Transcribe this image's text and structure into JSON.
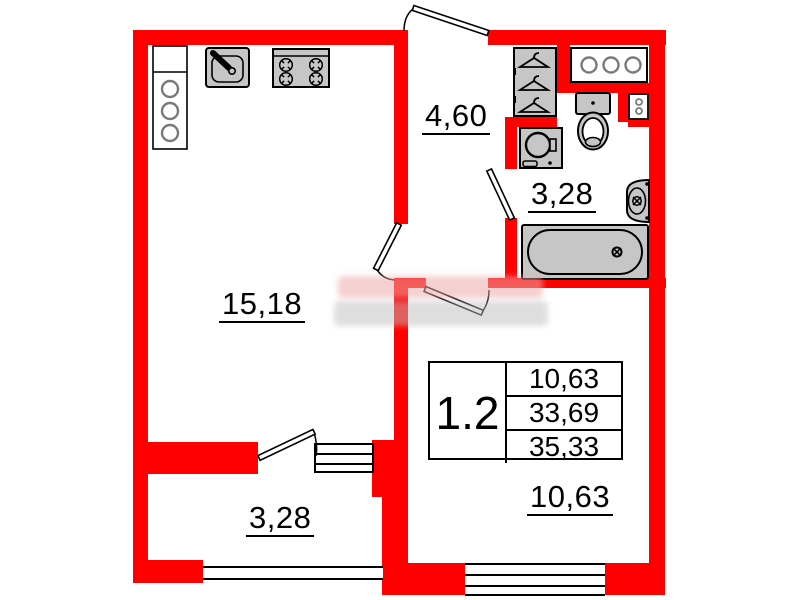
{
  "colors": {
    "wall": "#ff0000",
    "outline": "#000000",
    "fixture_fill": "#c6c6c6",
    "shaft_circle": "#7a7a7a",
    "watermark_pink": "#eeaaaa",
    "watermark_gray": "#bfbfbf"
  },
  "rooms": {
    "living": {
      "label": "15,18"
    },
    "hallway": {
      "label": "4,60"
    },
    "bathroom": {
      "label": "3,28"
    },
    "bedroom": {
      "label": "10,63"
    },
    "balcony": {
      "label": "3,28"
    }
  },
  "info_table": {
    "unit": "1.2",
    "rows": [
      "10,63",
      "33,69",
      "35,33"
    ]
  },
  "fixtures": [
    "ventilation-shaft",
    "kitchen-sink",
    "stove",
    "wardrobe",
    "utility-shaft",
    "toilet",
    "meter-box",
    "washing-machine",
    "washbasin",
    "bathtub"
  ]
}
